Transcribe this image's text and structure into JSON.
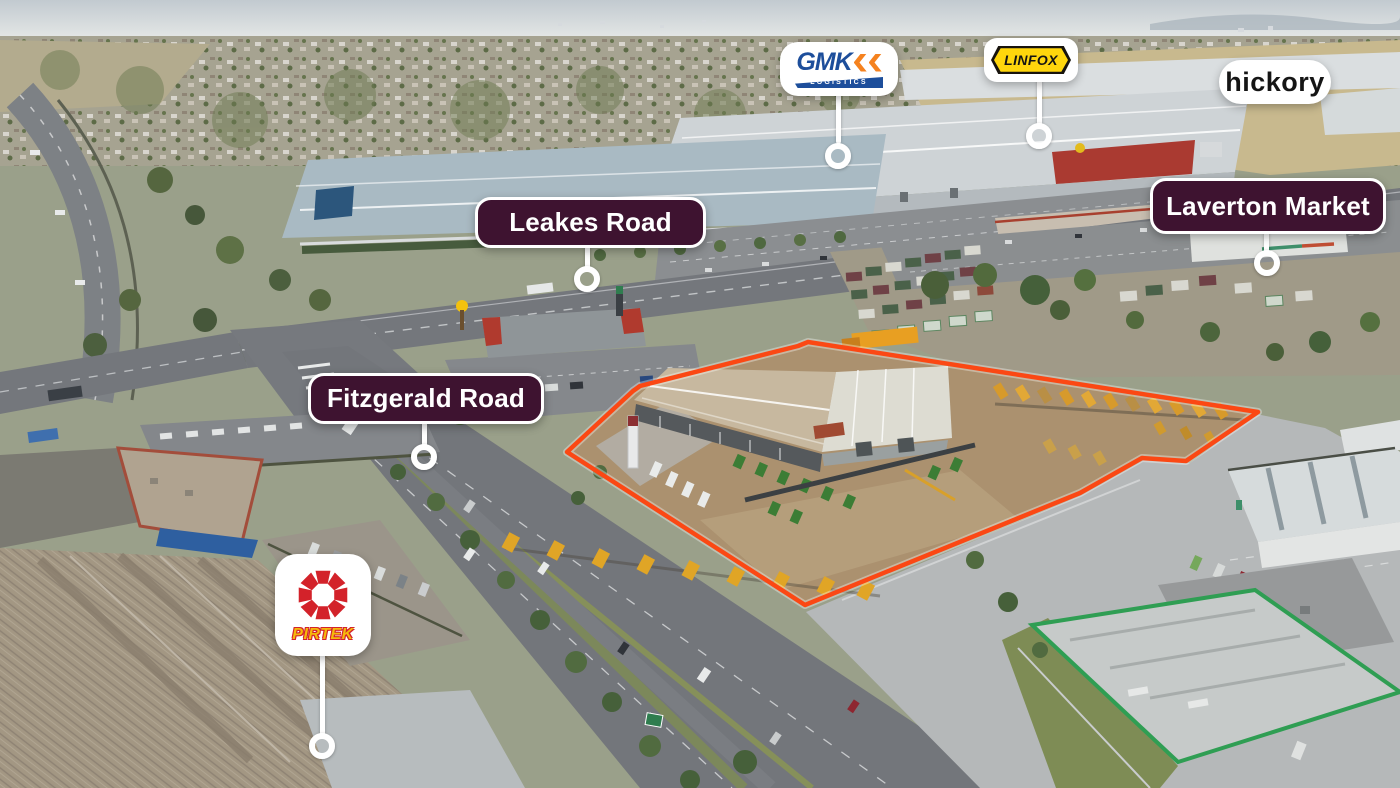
{
  "callouts": {
    "gmk": {
      "brand": "GMK",
      "tagline": "LOGISTICS"
    },
    "linfox": {
      "brand": "LINFOX"
    },
    "hickory": {
      "brand": "hickory"
    },
    "pirtek": {
      "brand": "PIRTEK"
    },
    "leakes_road": {
      "label": "Leakes Road"
    },
    "fitzgerald_road": {
      "label": "Fitzgerald Road"
    },
    "laverton_market": {
      "label": "Laverton Market"
    }
  },
  "colors": {
    "pill_bg": "#3E1330",
    "boundary_orange": "#FB4814",
    "gmk_blue": "#1D4E9B",
    "gmk_orange": "#F5821F",
    "linfox_yellow": "#FFD60C",
    "pirtek_red": "#D3222A",
    "pirtek_yellow": "#F5B90B"
  }
}
